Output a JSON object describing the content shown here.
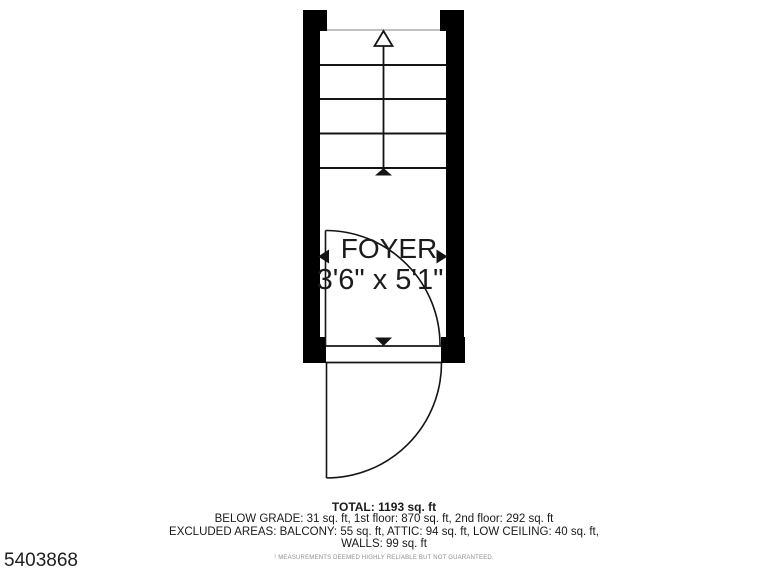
{
  "photo_id": "5403868",
  "floor_plan": {
    "room": {
      "name": "FOYER",
      "dimensions": "3'6\" x 5'1\""
    },
    "stairs": {
      "direction": "up",
      "tread_count": 4
    },
    "summary": {
      "total": "TOTAL: 1193 sq. ft",
      "breakdown": "BELOW GRADE: 31 sq. ft, 1st floor: 870 sq. ft, 2nd floor: 292 sq. ft",
      "excluded_line1": "EXCLUDED AREAS: BALCONY: 55 sq. ft, ATTIC: 94 sq. ft, LOW CEILING: 40 sq. ft,",
      "excluded_line2": "WALLS: 99 sq. ft",
      "disclaimer": "¹ MEASUREMENTS DEEMED HIGHLY RELIABLE BUT NOT GUARANTEED."
    },
    "colors": {
      "wall": "#000000",
      "line": "#141414",
      "faint_line": "#ababab",
      "text": "#1b1b1b",
      "disclaimer_text": "#8d8d8d"
    }
  }
}
